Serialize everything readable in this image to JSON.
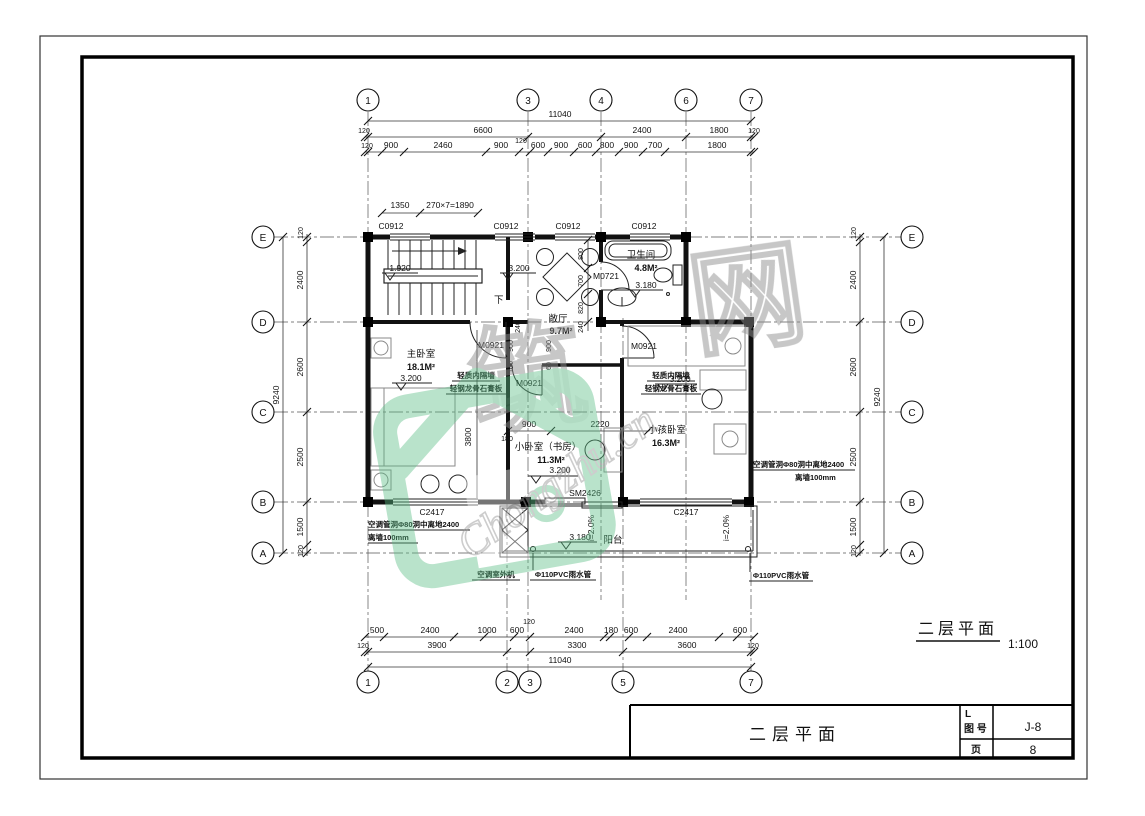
{
  "sheet": {
    "caption_title": "二层平面",
    "caption_scale": "1:100",
    "title_block": {
      "name": "二层平面",
      "no_label_line1": "L",
      "no_label_line2": "图 号",
      "no_value": "J-8",
      "page_label": "页",
      "page_value": "8"
    }
  },
  "grid": {
    "top": [
      "1",
      "3",
      "4",
      "6",
      "7"
    ],
    "bottom": [
      "1",
      "2",
      "3",
      "5",
      "7"
    ],
    "left": [
      "E",
      "D",
      "C",
      "B",
      "A"
    ],
    "right": [
      "E",
      "D",
      "C",
      "B",
      "A"
    ]
  },
  "dims": {
    "total_width": "11040",
    "total_height": "9240",
    "top_row2": [
      "120",
      "6600",
      "2400",
      "1800",
      "120"
    ],
    "top_row3": [
      "120",
      "900",
      "2460",
      "900",
      "120",
      "600",
      "900",
      "600",
      "800",
      "900",
      "700",
      "1800"
    ],
    "stair_row": [
      "1350",
      "270×7=1890"
    ],
    "bottom_row1": [
      "500",
      "2400",
      "1000",
      "600",
      "120",
      "2400",
      "180",
      "600",
      "2400",
      "600"
    ],
    "bottom_row2": [
      "120",
      "3900",
      "3300",
      "3600",
      "120"
    ],
    "side_col": [
      "120",
      "2400",
      "2600",
      "2500",
      "1500",
      "120"
    ],
    "hall_bath_chain": [
      "800",
      "700",
      "820",
      "240"
    ],
    "corridor_v1": [
      "900",
      "160"
    ],
    "corridor_v2": [
      "900",
      "60"
    ],
    "study_top": [
      "900",
      "2220"
    ],
    "master_depth": "3800",
    "wall_180": "180",
    "wall_240": "240"
  },
  "rooms": {
    "master": {
      "name": "主卧室",
      "area": "18.1M²",
      "level": "3.200"
    },
    "hall": {
      "name": "敞厅",
      "area": "9.7M²",
      "level": "3.200"
    },
    "stair": {
      "level": "1.920",
      "down": "下"
    },
    "bath": {
      "name": "卫生间",
      "area": "4.8M²",
      "level": "3.180"
    },
    "study": {
      "name": "小卧室（书房）",
      "area": "11.3M²",
      "level": "3.200"
    },
    "kids": {
      "name": "小孩卧室",
      "area": "16.3M²",
      "level": "3.200"
    },
    "balcony": {
      "name": "阳台",
      "level": "3.180",
      "slope": "i=2.0%"
    }
  },
  "openings": {
    "window_top": "C0912",
    "bath_door": "M0721",
    "room_door": "M0921",
    "balcony_door": "SM2426",
    "bottom_window": "C2417"
  },
  "notes": {
    "partition1": "轻质内隔墙",
    "partition2": "轻钢龙骨石膏板",
    "ac_hole1": "空调管洞Φ80洞中离地2400",
    "ac_hole2": "离墙100mm",
    "ac_unit": "空调室外机",
    "rain_pipe": "Φ110PVC雨水管"
  },
  "watermark": {
    "char1": "筑",
    "char2": "网",
    "url": "Chongzhu.cn"
  }
}
